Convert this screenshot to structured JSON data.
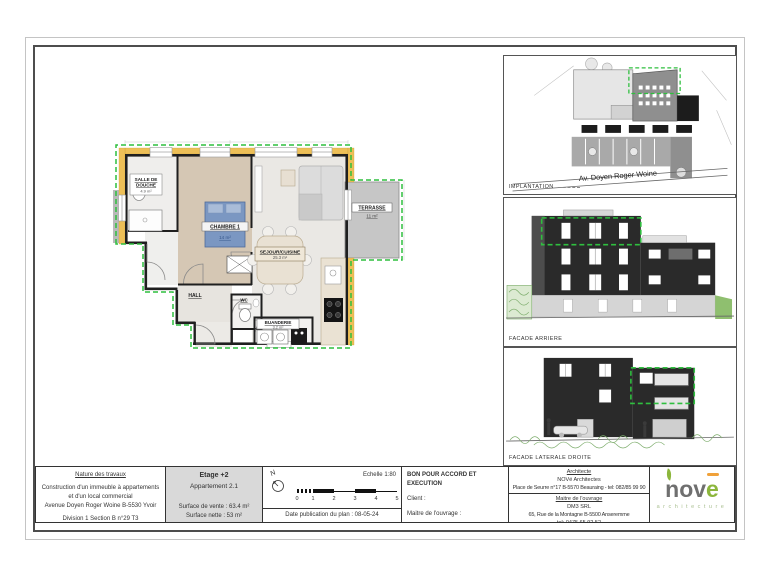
{
  "colors": {
    "highlight_green": "#2fbf3f",
    "insulation_yellow": "#edbf57",
    "facade_dark": "#2a2a2a",
    "logo_gray": "#6f6f6f",
    "logo_green": "#8cb63c",
    "logo_orange": "#f0a13a"
  },
  "plan": {
    "salle_de_douche": {
      "line1": "SALLE DE",
      "line2": "DOUCHE",
      "area": "4.9 m²"
    },
    "chambre": {
      "name": "CHAMBRE 1",
      "area": "14 m²"
    },
    "sejour": {
      "name": "SEJOUR/CUISINE",
      "area": "25.3 m²"
    },
    "terrasse": {
      "name": "TERRASSE",
      "area": "11 m²"
    },
    "hall": {
      "name": "HALL"
    },
    "wc": {
      "name": "WC"
    },
    "buanderie": {
      "name": "BUANDERIE",
      "area": "3.2 m²"
    }
  },
  "drawings": {
    "implantation": {
      "label": "IMPLANTATION",
      "street": "Av. Doyen Roger Woine"
    },
    "facade_arriere": {
      "label": "FACADE ARRIERE"
    },
    "facade_laterale": {
      "label": "FACADE LATERALE DROITE"
    }
  },
  "titleblock": {
    "nature": {
      "title": "Nature des travaux",
      "line1": "Construction d'un immeuble à appartements",
      "line2": "et d'un local commercial",
      "line3": "Avenue Doyen Roger Woine B-5530 Yvoir",
      "cadastre": "Division 1 Section B n°29 T3"
    },
    "etage": {
      "title": "Etage +2",
      "apartment": "Appartement 2.1",
      "surface_vente": "Surface de vente : 63.4 m²",
      "surface_nette": "Surface nette : 53 m²"
    },
    "scale": {
      "north": "N",
      "echelle": "Echelle 1:80",
      "ticks": [
        "0",
        "1",
        "2",
        "3",
        "4",
        "5"
      ],
      "date": "Date publication du plan : 08-05-24"
    },
    "approval": {
      "title": "BON POUR ACCORD ET EXECUTION",
      "client": "Client :",
      "maitre": "Maitre de l'ouvrage :"
    },
    "contacts": {
      "architect_title": "Architecte",
      "architect_name": "NOVé Architectes",
      "architect_address": "Place de Seurre n°17 B-5570 Beauraing - tel: 082/85 99 90",
      "owner_title": "Maitre de l'ouvrage",
      "owner_name": "DM3 SRL",
      "owner_address": "65, Rue de la Montagne B-5500 Anseremme",
      "owner_tel": "tel: 0475 65 92 52"
    },
    "logo": {
      "prefix": "nov",
      "e": "e",
      "subtitle": "architecture"
    }
  }
}
